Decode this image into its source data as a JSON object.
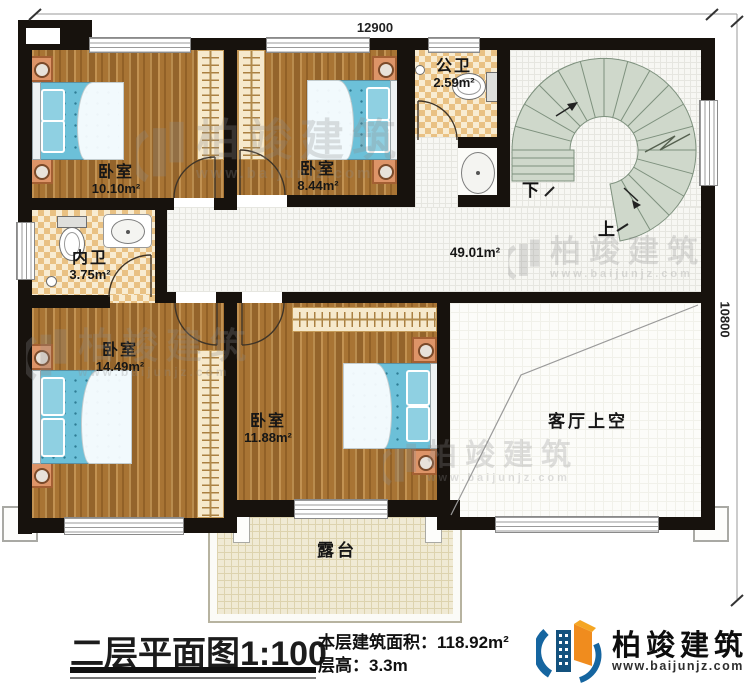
{
  "plan": {
    "dim_top": "12900",
    "dim_right": "10800",
    "rooms": {
      "bedroom1": {
        "name": "卧室",
        "area": "10.10m²"
      },
      "bedroom2": {
        "name": "卧室",
        "area": "8.44m²"
      },
      "public_bath": {
        "name": "公卫",
        "area": "2.59m²"
      },
      "ensuite_bath": {
        "name": "内卫",
        "area": "3.75m²"
      },
      "bedroom3": {
        "name": "卧室",
        "area": "14.49m²"
      },
      "bedroom4": {
        "name": "卧室",
        "area": "11.88m²"
      },
      "hall": {
        "area": "49.01m²"
      },
      "living_void": {
        "name": "客厅上空"
      },
      "terrace": {
        "name": "露台"
      }
    },
    "stair": {
      "down": "下",
      "up": "上"
    }
  },
  "watermark": {
    "brand": "柏竣建筑",
    "url": "www.baijunjz.com"
  },
  "footer": {
    "title": "二层平面图",
    "scale": "1:100",
    "area_label": "本层建筑面积：",
    "area_value": "118.92m²",
    "floor_height_label": "层高：",
    "floor_height_value": "3.3m",
    "logo_brand": "柏竣建筑",
    "logo_url": "www.baijunjz.com"
  },
  "colors": {
    "wall": "#17120d",
    "wood": "#a87434",
    "mattress": "#6cc0d8",
    "stair_tread": "#cfd8cb",
    "logo_blue": "#1565a0",
    "logo_orange": "#f08c1e"
  }
}
